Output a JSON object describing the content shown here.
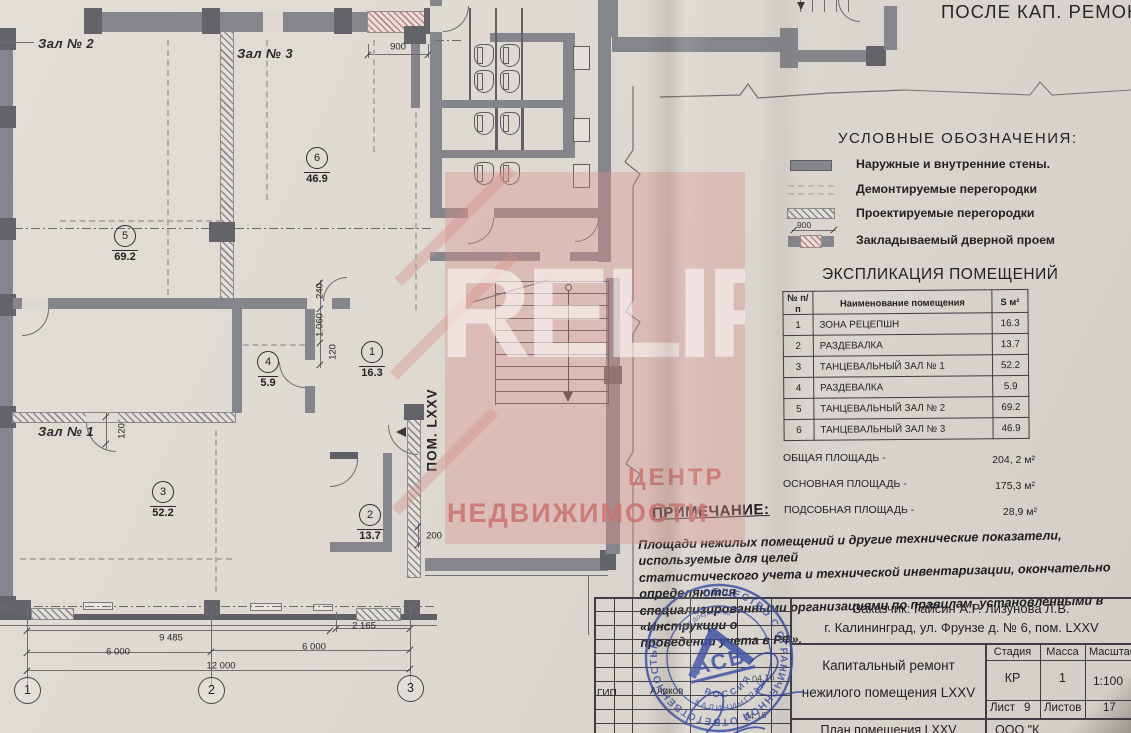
{
  "window": {
    "title": "ПОСЛЕ КАП. РЕМОНТА"
  },
  "watermark": {
    "brand": "RELIFE",
    "line1": "ЦЕНТР",
    "line2": "НЕДВИЖИМОСТИ",
    "color": "#c9726e"
  },
  "legend": {
    "title": "УСЛОВНЫЕ  ОБОЗНАЧЕНИЯ:",
    "items": [
      {
        "label": "Наружные и внутренние стены.",
        "swatch": "solid-wall"
      },
      {
        "label": "Демонтируемые перегородки",
        "swatch": "demolished-partition"
      },
      {
        "label": "Проектируемые перегородки",
        "swatch": "projected-partition"
      },
      {
        "label": "Закладываемый  дверной  проем",
        "swatch": "infill-door-opening",
        "dim": "900"
      }
    ]
  },
  "explication": {
    "title": "ЭКСПЛИКАЦИЯ ПОМЕЩЕНИЙ",
    "headers": [
      "№ п/п",
      "Наименование помещения",
      "S м²"
    ],
    "rows": [
      [
        "1",
        "ЗОНА РЕЦЕПШН",
        "16.3"
      ],
      [
        "2",
        "РАЗДЕВАЛКА",
        "13.7"
      ],
      [
        "3",
        "ТАНЦЕВАЛЬНЫЙ ЗАЛ № 1",
        "52.2"
      ],
      [
        "4",
        "РАЗДЕВАЛКА",
        "5.9"
      ],
      [
        "5",
        "ТАНЦЕВАЛЬНЫЙ ЗАЛ № 2",
        "69.2"
      ],
      [
        "6",
        "ТАНЦЕВАЛЬНЫЙ ЗАЛ № 3",
        "46.9"
      ]
    ],
    "totals": [
      {
        "label": "ОБЩАЯ ПЛОЩАДЬ -",
        "value": "204, 2 м²"
      },
      {
        "label": "ОСНОВНАЯ  ПЛОЩАДЬ -",
        "value": "175,3 м²"
      },
      {
        "label": "ПОДСОБНАЯ  ПЛОЩАДЬ -",
        "value": "28,9 м²"
      }
    ]
  },
  "note": {
    "title": "ПРИМЕЧАНИЕ:",
    "lines": [
      "Площади нежилых помещений и другие технические показатели, используемые для целей",
      "статистического учета и технической инвентаризации, окончательно определяются",
      "специализированными организациями по правилам, установленными в «Инструкции о",
      "проведении учета  в РФ»."
    ]
  },
  "titleblock": {
    "customer_line1": "Заказчик: Гайсин А.Р.  Лизунова Л.В.",
    "customer_line2": "г. Калининград, ул. Фрунзе д. № 6, пом. LXXV",
    "project_line1": "Капитальный ремонт",
    "project_line2": "нежилого помещения LXXV",
    "col_stage": "Стадия",
    "col_mass": "Масса",
    "col_scale": "Масштаб",
    "stage": "КР",
    "mass": "1",
    "scale": "1:100",
    "sheet_label": "Лист",
    "sheet_num": "9",
    "sheets_label": "Листов",
    "sheets_num": "17",
    "doc_name": "План помещения LXXV",
    "org_name": "ООО \"К",
    "role": "ГИП",
    "signer": "Аликов",
    "date1": "04.16",
    "date2": "04.16"
  },
  "stamp": {
    "ring_text": "ОБЩЕСТВО С ОГРАНИЧЕННОЙ ОТВЕТСТВЕННОСТЬЮ",
    "inner_arc": "для документов",
    "center": "АСБ",
    "country": "РОССИЯ",
    "city": "КАЛИНИНГРАД",
    "color": "#3b4da4"
  },
  "plan": {
    "pom_label": "ПОМ. LXXV",
    "room_labels": [
      {
        "text": "Зал № 2",
        "x": 38,
        "y": 36
      },
      {
        "text": "Зал № 3",
        "x": 237,
        "y": 46
      },
      {
        "text": "Зал № 1",
        "x": 38,
        "y": 424
      }
    ],
    "markers": [
      {
        "num": "5",
        "area": "69.2",
        "x": 125,
        "y": 236
      },
      {
        "num": "6",
        "area": "46.9",
        "x": 317,
        "y": 158
      },
      {
        "num": "4",
        "area": "5.9",
        "x": 268,
        "y": 362
      },
      {
        "num": "1",
        "area": "16.3",
        "x": 372,
        "y": 352
      },
      {
        "num": "3",
        "area": "52.2",
        "x": 163,
        "y": 492
      },
      {
        "num": "2",
        "area": "13.7",
        "x": 370,
        "y": 515
      }
    ],
    "dims": [
      {
        "t": "900",
        "x": 398,
        "y": 47
      },
      {
        "t": "240",
        "x": 320,
        "y": 291,
        "v": 1
      },
      {
        "t": "1.060",
        "x": 320,
        "y": 325,
        "v": 1
      },
      {
        "t": "120",
        "x": 333,
        "y": 352,
        "v": 1
      },
      {
        "t": "120",
        "x": 122,
        "y": 431,
        "v": 1
      },
      {
        "t": "200",
        "x": 434,
        "y": 536
      },
      {
        "t": "9 485",
        "x": 171,
        "y": 638
      },
      {
        "t": "2 165",
        "x": 364,
        "y": 626
      },
      {
        "t": "6 000",
        "x": 118,
        "y": 652
      },
      {
        "t": "6 000",
        "x": 314,
        "y": 647
      },
      {
        "t": "12 000",
        "x": 221,
        "y": 666
      }
    ],
    "axes": [
      {
        "num": "1",
        "x": 27,
        "y": 690
      },
      {
        "num": "2",
        "x": 211,
        "y": 690
      },
      {
        "num": "3",
        "x": 410,
        "y": 688
      }
    ]
  }
}
